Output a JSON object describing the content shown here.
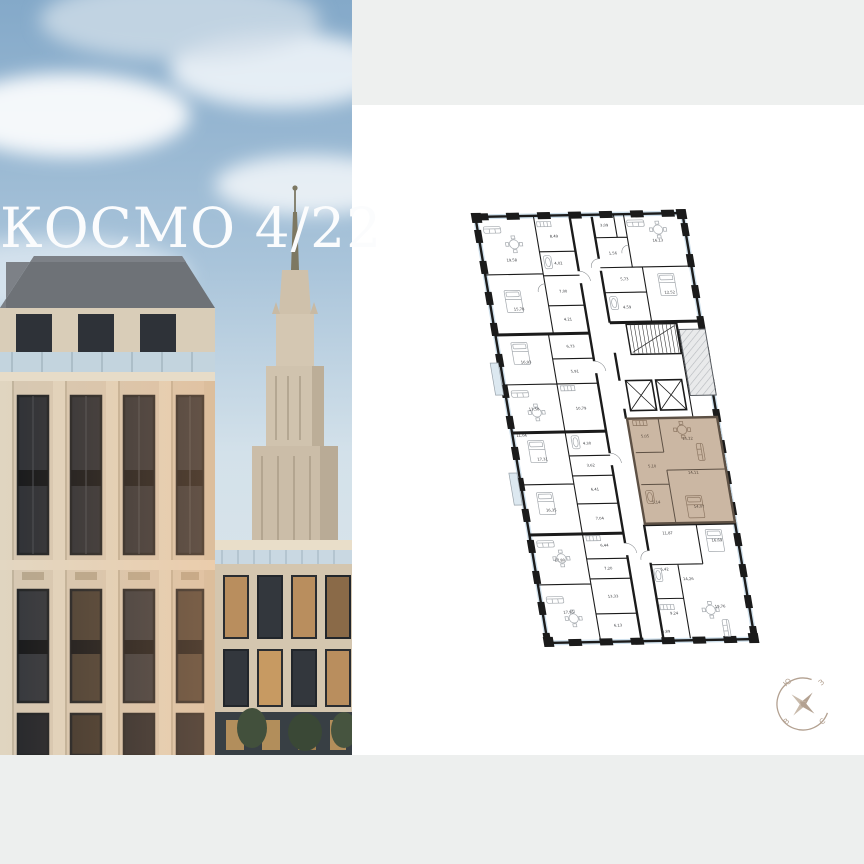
{
  "page": {
    "band_color": "#eef0ef",
    "panel_color": "#ffffff"
  },
  "hero": {
    "title": "КОСМО 4/22"
  },
  "floor_plan": {
    "wall_color": "#1b1b1b",
    "glazing_color": "#cfe0ec",
    "label_color": "#3f4145",
    "highlight_fill": "#cbb7a3",
    "highlight_wall": "#5d5044",
    "highlight_label_color": "#52453a",
    "rooms": [
      {
        "label": "19,58",
        "x": 31,
        "y": 47,
        "zone": "standard"
      },
      {
        "label": "8,49",
        "x": 77,
        "y": 24,
        "zone": "standard"
      },
      {
        "label": "4,02",
        "x": 77,
        "y": 51,
        "zone": "standard"
      },
      {
        "label": "7,00",
        "x": 77,
        "y": 79,
        "zone": "standard"
      },
      {
        "label": "15,78",
        "x": 30,
        "y": 96,
        "zone": "standard"
      },
      {
        "label": "4,21",
        "x": 77,
        "y": 107,
        "zone": "standard"
      },
      {
        "label": "16,93",
        "x": 28,
        "y": 149,
        "zone": "standard"
      },
      {
        "label": "6,73",
        "x": 75,
        "y": 134,
        "zone": "standard"
      },
      {
        "label": "5,91",
        "x": 75,
        "y": 159,
        "zone": "standard"
      },
      {
        "label": "13,58",
        "x": 28,
        "y": 196,
        "zone": "standard"
      },
      {
        "label": "10,79",
        "x": 75,
        "y": 196,
        "zone": "standard"
      },
      {
        "label": "11,04",
        "x": 11,
        "y": 222,
        "zone": "standard"
      },
      {
        "label": "4,30",
        "x": 75,
        "y": 231,
        "zone": "standard"
      },
      {
        "label": "17,31",
        "x": 28,
        "y": 246,
        "zone": "standard"
      },
      {
        "label": "3,62",
        "x": 75,
        "y": 253,
        "zone": "standard"
      },
      {
        "label": "16,35",
        "x": 28,
        "y": 297,
        "zone": "standard"
      },
      {
        "label": "6,41",
        "x": 75,
        "y": 277,
        "zone": "standard"
      },
      {
        "label": "7,04",
        "x": 75,
        "y": 306,
        "zone": "standard"
      },
      {
        "label": "17,80",
        "x": 28,
        "y": 347,
        "zone": "standard"
      },
      {
        "label": "6,44",
        "x": 75,
        "y": 333,
        "zone": "standard"
      },
      {
        "label": "7,20",
        "x": 75,
        "y": 356,
        "zone": "standard"
      },
      {
        "label": "17,95",
        "x": 28,
        "y": 399,
        "zone": "standard"
      },
      {
        "label": "13,33",
        "x": 75,
        "y": 384,
        "zone": "standard"
      },
      {
        "label": "6,13",
        "x": 75,
        "y": 413,
        "zone": "standard"
      },
      {
        "label": "3,09",
        "x": 129,
        "y": 14,
        "zone": "standard"
      },
      {
        "label": "16,13",
        "x": 180,
        "y": 30,
        "zone": "standard"
      },
      {
        "label": "1,56",
        "x": 133,
        "y": 42,
        "zone": "standard"
      },
      {
        "label": "5,73",
        "x": 140,
        "y": 68,
        "zone": "standard"
      },
      {
        "label": "12,52",
        "x": 183,
        "y": 82,
        "zone": "standard"
      },
      {
        "label": "4,59",
        "x": 138,
        "y": 96,
        "zone": "standard"
      },
      {
        "label": "11,87",
        "x": 140,
        "y": 322,
        "zone": "standard"
      },
      {
        "label": "16,69",
        "x": 188,
        "y": 330,
        "zone": "standard"
      },
      {
        "label": "5,42",
        "x": 131,
        "y": 358,
        "zone": "standard"
      },
      {
        "label": "14,26",
        "x": 153,
        "y": 368,
        "zone": "standard"
      },
      {
        "label": "19,76",
        "x": 180,
        "y": 396,
        "zone": "standard"
      },
      {
        "label": "9,24",
        "x": 133,
        "y": 402,
        "zone": "standard"
      },
      {
        "label": "5,89",
        "x": 122,
        "y": 420,
        "zone": "standard"
      },
      {
        "label": "5,05",
        "x": 134,
        "y": 225,
        "zone": "highlight"
      },
      {
        "label": "15,22",
        "x": 176,
        "y": 228,
        "zone": "highlight"
      },
      {
        "label": "5,10",
        "x": 136,
        "y": 255,
        "zone": "highlight"
      },
      {
        "label": "14,11",
        "x": 176,
        "y": 262,
        "zone": "highlight"
      },
      {
        "label": "5,14",
        "x": 134,
        "y": 291,
        "zone": "highlight"
      },
      {
        "label": "14,07",
        "x": 176,
        "y": 296,
        "zone": "highlight"
      }
    ]
  },
  "compass": {
    "color": "#b3a191",
    "letters": {
      "top_left": "Ю",
      "top_right": "З",
      "bottom_left": "В",
      "bottom_right": "С"
    }
  }
}
